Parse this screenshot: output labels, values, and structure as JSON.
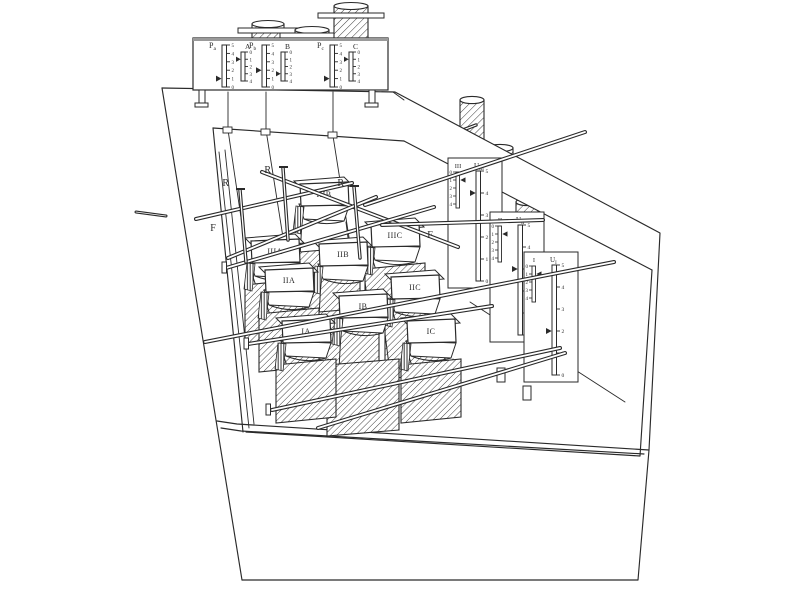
{
  "figure": {
    "background": "#ffffff",
    "ink": "#2a2a2a"
  },
  "top_panel": {
    "meters": [
      {
        "label_main": "P",
        "label_sub": "a",
        "phase_label": "A",
        "main_ticks": [
          "5",
          "4",
          "3",
          "2",
          "1",
          "0"
        ],
        "main_pointer": 1,
        "phase_ticks": [
          "0",
          "1",
          "2",
          "3",
          "4"
        ],
        "phase_pointer": 1
      },
      {
        "label_main": "P",
        "label_sub": "b",
        "phase_label": "B",
        "main_ticks": [
          "5",
          "4",
          "3",
          "2",
          "1",
          "0"
        ],
        "main_pointer": 2,
        "phase_ticks": [
          "0",
          "1",
          "2",
          "3",
          "4"
        ],
        "phase_pointer": 3
      },
      {
        "label_main": "P",
        "label_sub": "c",
        "phase_label": "C",
        "main_ticks": [
          "5",
          "4",
          "3",
          "2",
          "1",
          "0"
        ],
        "main_pointer": 1,
        "phase_ticks": [
          "0",
          "1",
          "2",
          "3",
          "4"
        ],
        "phase_pointer": 1
      }
    ]
  },
  "right_wall_panels": [
    {
      "row_label": "III",
      "u_label": "U",
      "u_sub": "III",
      "row_ticks": [
        "0",
        "1",
        "2",
        "3",
        "4"
      ],
      "row_pointer": 1,
      "u_ticks": [
        "5",
        "4",
        "3",
        "2",
        "1",
        "0"
      ],
      "u_pointer": 4
    },
    {
      "row_label": "II",
      "u_label": "U",
      "u_sub": "II",
      "row_ticks": [
        "0",
        "1",
        "2",
        "3",
        "4"
      ],
      "row_pointer": 1,
      "u_ticks": [
        "5",
        "4",
        "3",
        "2",
        "1",
        "0"
      ],
      "u_pointer": 3
    },
    {
      "row_label": "I",
      "u_label": "U",
      "u_sub": "I",
      "row_ticks": [
        "0",
        "1",
        "2",
        "3",
        "4"
      ],
      "row_pointer": 1,
      "u_ticks": [
        "5",
        "4",
        "3",
        "2",
        "1",
        "0"
      ],
      "u_pointer": 2
    }
  ],
  "hoppers": [
    {
      "label": "IIIB"
    },
    {
      "label": "IIIA"
    },
    {
      "label": "IIIC"
    },
    {
      "label": "IIB"
    },
    {
      "label": "IIA"
    },
    {
      "label": "IIC"
    },
    {
      "label": "IB"
    },
    {
      "label": "IA"
    },
    {
      "label": "IC"
    }
  ],
  "rod_labels": {
    "release": "R",
    "feed": "F"
  }
}
